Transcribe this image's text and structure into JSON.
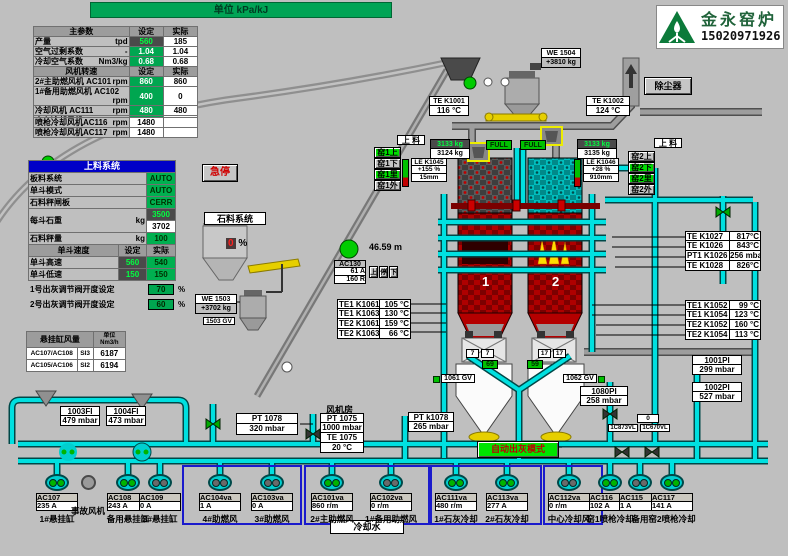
{
  "banner": {
    "unit": "单位  kPa/kJ"
  },
  "logo": {
    "company": "金永窑炉",
    "phone": "15020971926"
  },
  "main_table": {
    "header": {
      "c1": "主参数",
      "c2": "设定",
      "c3": "实际"
    },
    "rows": [
      {
        "label": "产量",
        "unit": "tpd",
        "set": "560",
        "actual": "185"
      },
      {
        "label": "空气过剩系数",
        "unit": "-",
        "set": "1.04",
        "actual": "1.04"
      },
      {
        "label": "冷却空气系数",
        "unit": "Nm3/kg",
        "set": "0.68",
        "actual": "0.68"
      }
    ],
    "fan_header": {
      "c1": "风机转速",
      "c2": "设定",
      "c3": "实际"
    },
    "fan_rows": [
      {
        "label": "2#主助燃风机 AC101",
        "unit": "rpm",
        "set": "860",
        "actual": "860"
      },
      {
        "label": "1#备用助燃风机 AC102",
        "unit": "rpm",
        "set": "400",
        "actual": "0"
      },
      {
        "label": "冷却风机 AC111",
        "unit": "rpm",
        "set": "480",
        "actual": "480"
      },
      {
        "label": "中心冷却风机 AC112",
        "unit": "rpm",
        "set": "260",
        "actual": "0"
      }
    ],
    "lance_rows": [
      {
        "label": "喷枪冷却风机AC116",
        "unit": "rpm",
        "value": "1480"
      },
      {
        "label": "喷枪冷却风机AC117",
        "unit": "rpm",
        "value": "1480"
      }
    ]
  },
  "feed_table": {
    "title": "上料系统",
    "rows": [
      {
        "label": "板料系统",
        "value": "AUTO"
      },
      {
        "label": "单斗模式",
        "value": "AUTO"
      },
      {
        "label": "石料秤闸板",
        "value": "CERR"
      }
    ],
    "weight_row": {
      "label": "每斗石重",
      "unit": "kg",
      "set": "3500",
      "actual": "3702"
    },
    "check_row": {
      "label": "石料秤量",
      "unit": "kg",
      "value": "100"
    },
    "speed_header": {
      "c1": "单斗速度",
      "c2": "设定",
      "c3": "实际"
    },
    "speed_rows": [
      {
        "label": "单斗高速",
        "set": "560",
        "actual": "540"
      },
      {
        "label": "单斗低速",
        "set": "150",
        "actual": "150"
      }
    ]
  },
  "ash_settings": [
    {
      "label": "1号出灰调节阀开度设定",
      "value": "70",
      "unit": "%"
    },
    {
      "label": "2号出灰调节阀开度设定",
      "value": "60",
      "unit": "%"
    }
  ],
  "flow_table": {
    "header": "悬挂缸风量",
    "unit": "单位 Nm3/h",
    "rows": [
      {
        "tag": "AC107/AC108",
        "code": "SI3",
        "value": "6187"
      },
      {
        "tag": "AC105/AC106",
        "code": "SI2",
        "value": "6194"
      }
    ]
  },
  "buttons": {
    "estop": "急停",
    "dust": "除尘器",
    "auto_ash": "自动出灰模式",
    "feed_left": "上 料",
    "feed_right": "上 料",
    "kiln1": [
      "窑1上",
      "窑1下",
      "窑1里",
      "窑1外"
    ],
    "kiln2": [
      "窑2上",
      "窑2下",
      "窑2里",
      "窑2外"
    ],
    "hoist": [
      "上",
      "停",
      "下"
    ]
  },
  "labels": {
    "stone_system": "石料系统",
    "fan_room": "风机房",
    "cooling_water": "冷却水",
    "emergency_fan": "事故风机",
    "height": "46.59    m",
    "kiln1_no": "1",
    "kiln2_no": "2",
    "hopper_pct": "0",
    "hopper_pct_unit": "%",
    "pos1": "69",
    "pos2": "59",
    "zero": "0",
    "pair_left": [
      "7",
      "7"
    ],
    "pair_right": [
      "17",
      "17"
    ],
    "full_left": "FULL",
    "full_right": "FULL"
  },
  "inst": {
    "we1504": {
      "tag": "WE 1504",
      "value": "+3810  kg"
    },
    "te_k1001": {
      "tag": "TE K1001",
      "value": "116 °C"
    },
    "te_k1002": {
      "tag": "TE K1002",
      "value": "124  °C"
    },
    "k1_charge": {
      "set": "3133 kg",
      "actual": "3124 kg"
    },
    "k2_charge": {
      "set": "3133 kg",
      "actual": "3135 kg"
    },
    "le_k1045": {
      "tag": "LE K1045",
      "pct": "+155   %",
      "mm": "15mm"
    },
    "le_k1046": {
      "tag": "LE K1046",
      "pct": "+28   %",
      "mm": "910mm"
    },
    "pi1001": {
      "tag": "1001PI",
      "value": "299 mbar"
    },
    "pi1002": {
      "tag": "1002PI",
      "value": "527 mbar"
    },
    "pi1080": {
      "tag": "1080PI",
      "value": "258 mbar"
    },
    "pt1078": {
      "tag": "PT 1078",
      "value": "320  mbar"
    },
    "pt_k1078": {
      "tag": "PT k1078",
      "value": "265  mbar"
    },
    "fan_room_rows": [
      "PT 1075",
      "1000 mbar",
      "TE 1075",
      "20    °C"
    ],
    "fi1003": {
      "tag": "1003FI",
      "value": "479 mbar"
    },
    "fi1004": {
      "tag": "1004FI",
      "value": "473 mbar"
    },
    "gv1061": "1061 GV",
    "gv1062": "1062 GV",
    "gv1503": "1503 GV",
    "we1503": {
      "tag": "WE 1503",
      "value": "+3702  kg"
    },
    "ac130": {
      "tag": "AC130",
      "amp": "61 A",
      "r": "160 R"
    },
    "vl_left": "1C873VL",
    "vl_right": "1C670VL"
  },
  "right_top": [
    [
      "TE K1027",
      "817°C"
    ],
    [
      "TE K1026",
      "843°C"
    ],
    [
      "PT1 K1026",
      "256 mbar"
    ],
    [
      "TE K1028",
      "826°C"
    ]
  ],
  "right_mid": [
    [
      "TE1 K1052",
      "99   °C"
    ],
    [
      "TE1 K1054",
      "123   °C"
    ],
    [
      "TE2 K1052",
      "160   °C"
    ],
    [
      "TE2 K1054",
      "113   °C"
    ]
  ],
  "left_mid": [
    [
      "TE1 K1061",
      "105 °C"
    ],
    [
      "TE1 K1063",
      "130 °C"
    ],
    [
      "TE2 K1061",
      "159 °C"
    ],
    [
      "TE2 K1063",
      "66 °C"
    ]
  ],
  "motors": [
    {
      "tag": "AC107",
      "value": "235 A",
      "label": "1#悬挂缸"
    },
    {
      "label": "事故风机"
    },
    {
      "tag": "AC108",
      "value": "243 A",
      "label": "备用悬挂缸"
    },
    {
      "tag": "AC109",
      "value": "0 A",
      "label": "3#悬挂缸"
    },
    {
      "tag": "AC104va",
      "value": "1 A",
      "label": "4#助燃风"
    },
    {
      "tag": "AC103va",
      "value": "0 A",
      "label": "3#助燃风"
    },
    {
      "tag": "AC101va",
      "value": "860 r/m",
      "label": "2#主助燃风"
    },
    {
      "tag": "AC102va",
      "value": "0 r/m",
      "label": "1#备用助燃风"
    },
    {
      "tag": "AC111va",
      "value": "480 r/m",
      "label": "1#石灰冷却"
    },
    {
      "tag": "AC113va",
      "value": "277 A",
      "label": "2#石灰冷却"
    },
    {
      "tag": "AC112va",
      "value": "0 r/m",
      "label": "中心冷却风"
    },
    {
      "tag": "AC116",
      "value": "102 A",
      "label": "窑1喷枪冷却"
    },
    {
      "tag": "AC115",
      "value": "1 A",
      "label": "备用"
    },
    {
      "tag": "AC117",
      "value": "141 A",
      "label": "窑2喷枪冷却"
    }
  ],
  "colors": {
    "pipe": "#00E0E0",
    "kiln_red": "#B40000",
    "accent_green": "#00B050",
    "hmi_bg": "#BFBFBF"
  }
}
